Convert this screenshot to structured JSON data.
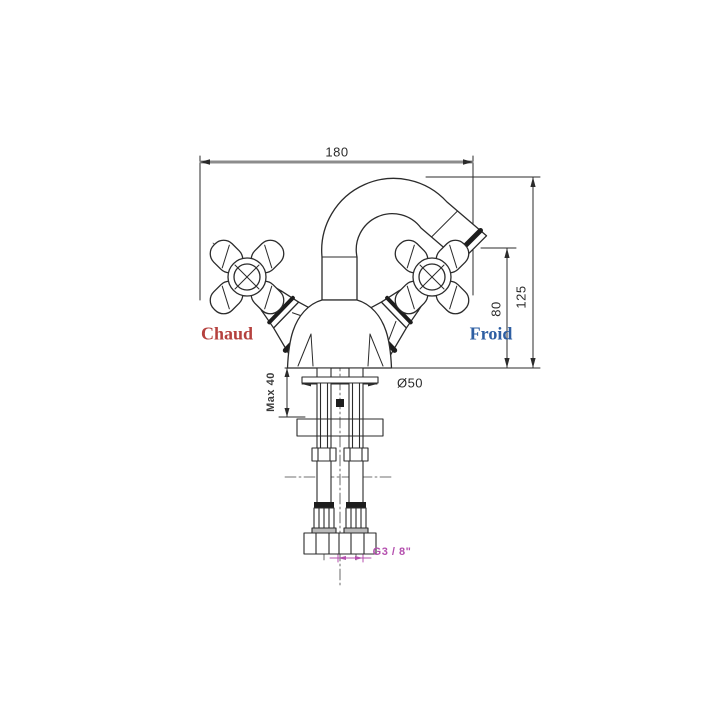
{
  "page": {
    "background": "#ffffff",
    "title": "Mixer tap installation drawing"
  },
  "drawing": {
    "kind": "technical line drawing",
    "subject": "Single-hole bidet mixer tap with cross handles, front elevation with installation dimensions",
    "labels": {
      "hot": "Chaud",
      "cold": "Froid"
    },
    "dimensions": {
      "overall_width": "180",
      "overall_height": "125",
      "spout_outlet_height": "80",
      "max_deck_thickness": "Max 40",
      "base_diameter": "Ø50",
      "supply_connection": "G3 / 8\""
    },
    "colors": {
      "line": "#2b2b2b",
      "dim_line_gray": "#8c8c8c",
      "hot": "#b5413e",
      "cold": "#2e5fa3",
      "thread_magenta": "#b44fae"
    }
  }
}
